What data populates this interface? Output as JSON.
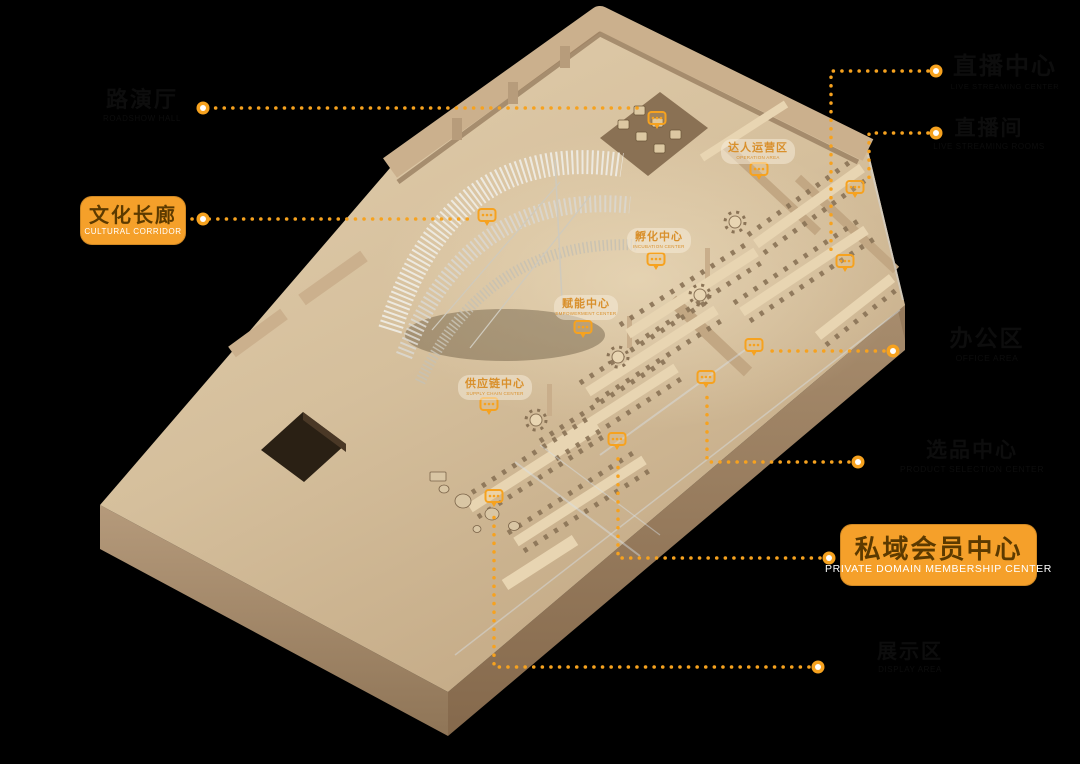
{
  "figure": {
    "kind": "axonometric office floor plan diagram",
    "background": "#000000"
  },
  "colors": {
    "accent_orange": "#F6A21F",
    "label_box": "#F5A02A",
    "label_zh_text": "#5C3A00",
    "label_en_text": "#FFFFFF",
    "dark_label_text": "#0D0D0D",
    "floor_tag_text": "#D9902C",
    "wood_floor": "#D8C3A1"
  },
  "primary_labels": [
    {
      "zh": "文化长廊",
      "en": "CULTURAL CORRIDOR"
    },
    {
      "zh": "私域会员中心",
      "en": "PRIVATE DOMAIN MEMBERSHIP CENTER"
    }
  ],
  "dark_labels": [
    {
      "zh": "路演厅",
      "en": "ROADSHOW HALL"
    },
    {
      "zh": "直播中心",
      "en": "LIVE STREAMING CENTER"
    },
    {
      "zh": "直播间",
      "en": "LIVE STREAMING ROOMS"
    },
    {
      "zh": "办公区",
      "en": "OFFICE AREA"
    },
    {
      "zh": "选品中心",
      "en": "PRODUCT SELECTION CENTER"
    },
    {
      "zh": "展示区",
      "en": "DISPLAY AREA"
    }
  ],
  "floor_tags": [
    {
      "zh": "达人运营区",
      "en": "OPERATION AREA"
    },
    {
      "zh": "孵化中心",
      "en": "INCUBATION CENTER"
    },
    {
      "zh": "赋能中心",
      "en": "EMPOWERMENT CENTER"
    },
    {
      "zh": "供应链中心",
      "en": "SUPPLY CHAIN CENTER"
    }
  ]
}
